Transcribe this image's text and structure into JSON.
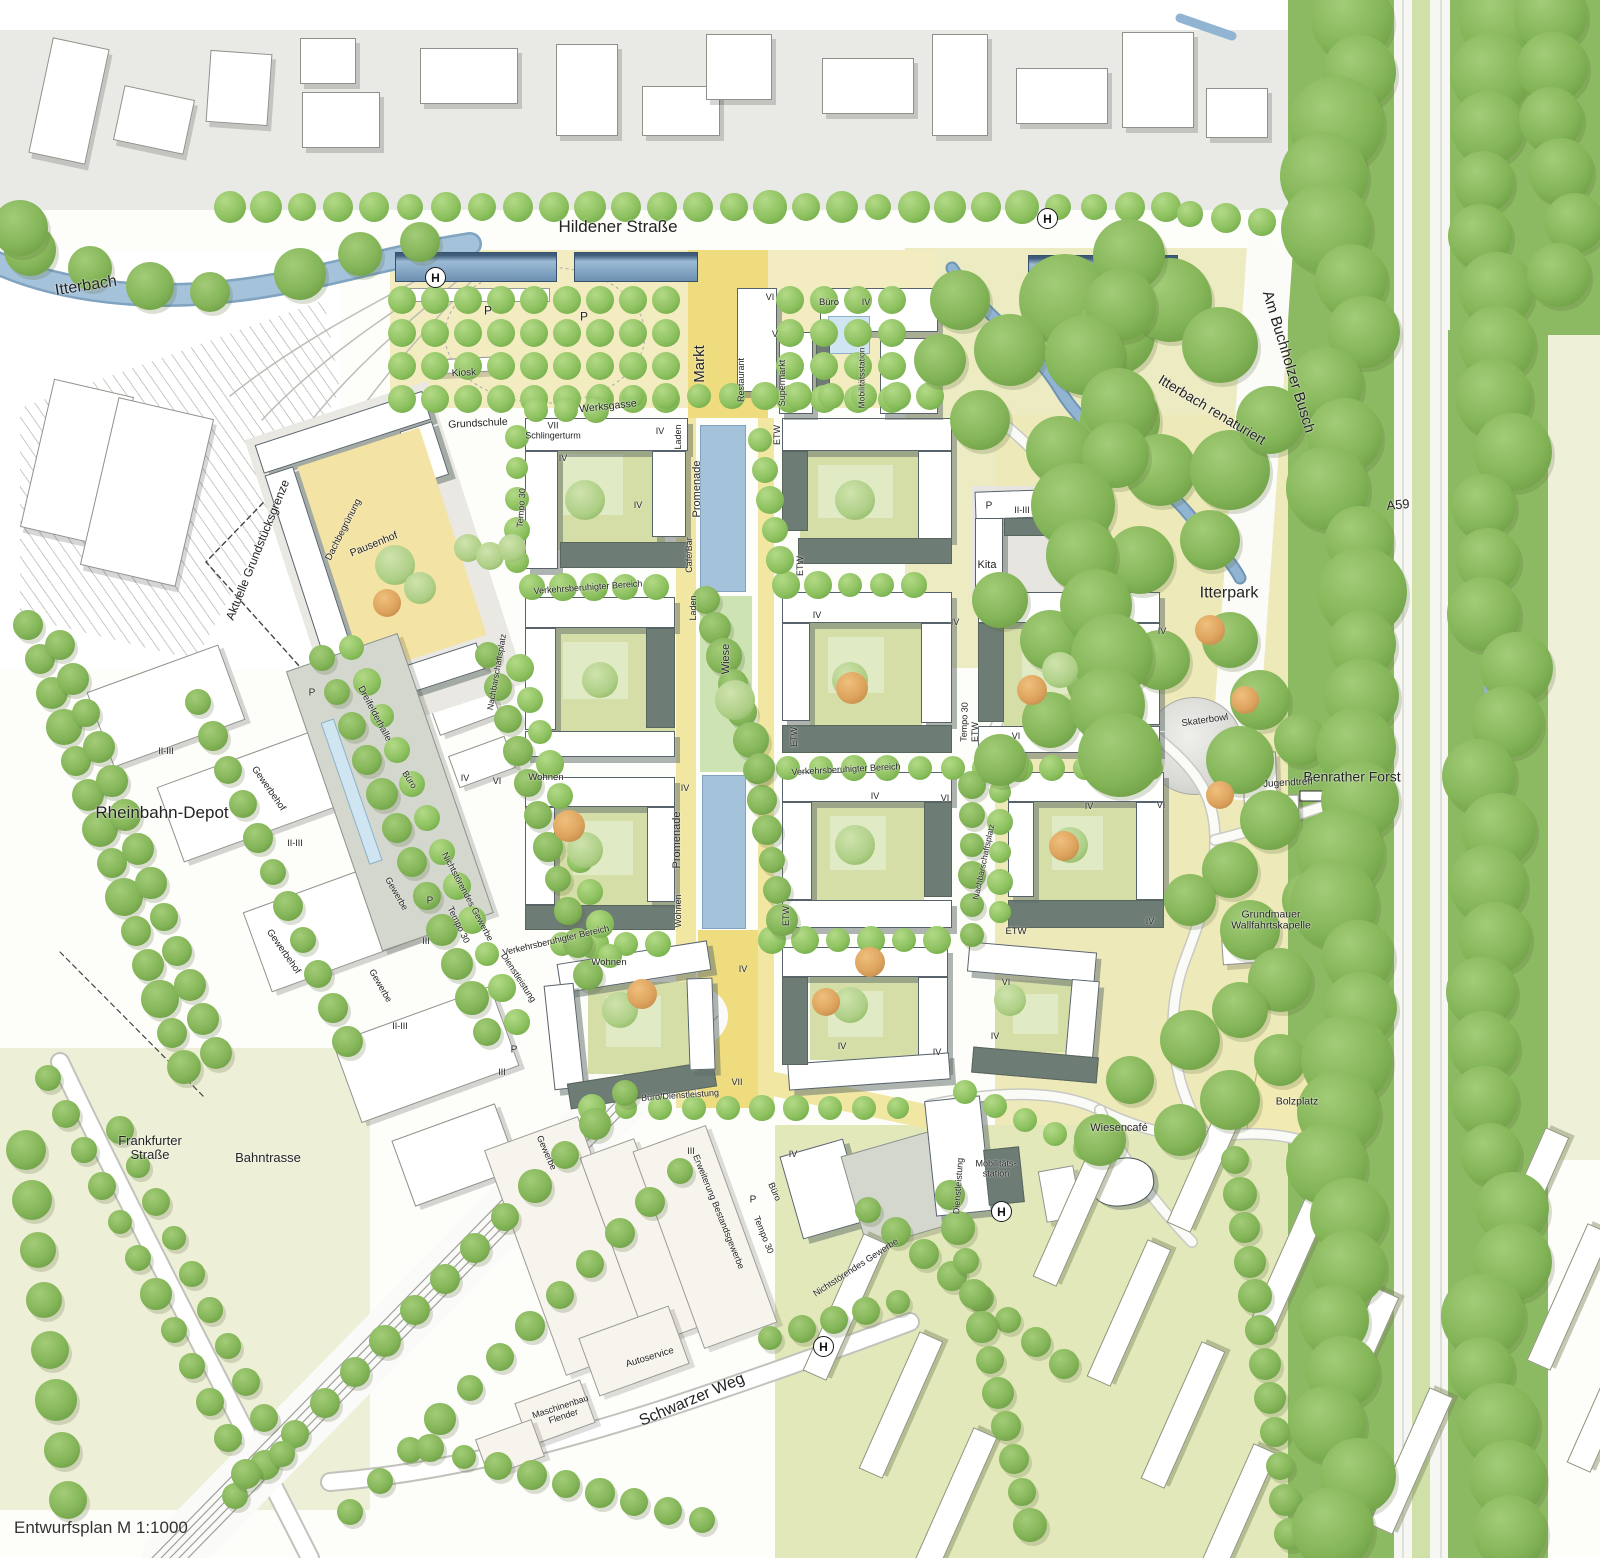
{
  "map_title": "Entwurfsplan Masterplan",
  "footer": {
    "scale_note": "Entwurfsplan M 1:1000"
  },
  "transit_stop_symbol": "H",
  "colors": {
    "water": "#a4c2da",
    "water_edge": "#7fa3c0",
    "stream": "#90b4d2",
    "forest_green": "#8cba62",
    "street_tree": "#8cc05e",
    "meadow_yellow": "#eee9b9",
    "meadow_ne": "#ecebc2",
    "plaza_light": "#f2ecc0",
    "axis_yellow": "#eedc7e",
    "promenade_yellow": "#f1e7a3",
    "courtyard_olive": "#d5dea6",
    "lawn_light": "#e0ebc6",
    "roof_dark": "#6d7c74",
    "canopy_blue": "#7b9cc0",
    "lawn_se": "#e2e8ba",
    "lawn_sw": "#edefd6",
    "median_a59": "#cfe0a8",
    "existing_parcel": "#e9e9e5",
    "paving_grey": "#e9e8e2"
  },
  "stops": [
    {
      "x": 435,
      "y": 277
    },
    {
      "x": 1047,
      "y": 218
    },
    {
      "x": 1001,
      "y": 1211
    },
    {
      "x": 823,
      "y": 1346
    }
  ],
  "labels": [
    {
      "t": "Hildener Straße",
      "x": 618,
      "y": 227,
      "r": 0,
      "s": 17
    },
    {
      "t": "Itterbach",
      "x": 86,
      "y": 286,
      "r": -9,
      "s": 16
    },
    {
      "t": "Rheinbahn-Depot",
      "x": 162,
      "y": 813,
      "r": 0,
      "s": 17
    },
    {
      "t": "Aktuelle Grundstücksgrenze",
      "x": 258,
      "y": 550,
      "r": -68,
      "s": 12
    },
    {
      "t": "Am Buchholzer Busch",
      "x": 1288,
      "y": 362,
      "r": 73,
      "s": 15
    },
    {
      "t": "Itterbach renaturiert",
      "x": 1212,
      "y": 410,
      "r": 31,
      "s": 14
    },
    {
      "t": "A59",
      "x": 1398,
      "y": 505,
      "r": -5,
      "s": 13
    },
    {
      "t": "Benrather Forst",
      "x": 1352,
      "y": 777,
      "r": 0,
      "s": 14
    },
    {
      "t": "Itterpark",
      "x": 1229,
      "y": 593,
      "r": 0,
      "s": 16
    },
    {
      "t": "Frankfurter\nStraße",
      "x": 150,
      "y": 1148,
      "r": 0,
      "s": 13
    },
    {
      "t": "Bahntrasse",
      "x": 268,
      "y": 1158,
      "r": 0,
      "s": 13
    },
    {
      "t": "Schwarzer Weg",
      "x": 692,
      "y": 1400,
      "r": -23,
      "s": 16
    },
    {
      "t": "Markt",
      "x": 700,
      "y": 364,
      "r": -90,
      "s": 15
    },
    {
      "t": "Werksgasse",
      "x": 608,
      "y": 407,
      "r": -6,
      "s": 10.5
    },
    {
      "t": "Kiosk",
      "x": 464,
      "y": 374,
      "r": -3,
      "s": 10
    },
    {
      "t": "Grundschule",
      "x": 478,
      "y": 424,
      "r": -3,
      "s": 10.5
    },
    {
      "t": "Pausenhof",
      "x": 374,
      "y": 545,
      "r": -22,
      "s": 10.5
    },
    {
      "t": "Dachbegrünung",
      "x": 344,
      "y": 530,
      "r": -63,
      "s": 9.5
    },
    {
      "t": "Dreifelderhalle",
      "x": 374,
      "y": 714,
      "r": 62,
      "s": 9.5
    },
    {
      "t": "VII\nSchlingerturm",
      "x": 553,
      "y": 431,
      "r": 0,
      "s": 9
    },
    {
      "t": "Tempo 30",
      "x": 522,
      "y": 508,
      "r": -86,
      "s": 9
    },
    {
      "t": "Tempo 30",
      "x": 965,
      "y": 722,
      "r": -88,
      "s": 9
    },
    {
      "t": "Tempo 30",
      "x": 458,
      "y": 925,
      "r": 64,
      "s": 9
    },
    {
      "t": "Tempo 30",
      "x": 763,
      "y": 1235,
      "r": 68,
      "s": 9
    },
    {
      "t": "Promenade",
      "x": 698,
      "y": 489,
      "r": -90,
      "s": 11
    },
    {
      "t": "Promenade",
      "x": 678,
      "y": 840,
      "r": -90,
      "s": 11
    },
    {
      "t": "Wiese",
      "x": 727,
      "y": 659,
      "r": -90,
      "s": 11
    },
    {
      "t": "Verkehrsberuhigter Bereich",
      "x": 588,
      "y": 588,
      "r": -4,
      "s": 9
    },
    {
      "t": "Verkehrsberuhigter Bereich",
      "x": 846,
      "y": 770,
      "r": -3,
      "s": 9
    },
    {
      "t": "Verkehrsberuhigter Bereich",
      "x": 556,
      "y": 941,
      "r": -13,
      "s": 9
    },
    {
      "t": "Nachbarschaftsplatz",
      "x": 497,
      "y": 672,
      "r": -80,
      "s": 8.5
    },
    {
      "t": "Nachbarschaftsplatz",
      "x": 984,
      "y": 862,
      "r": -78,
      "s": 8.5
    },
    {
      "t": "Kita",
      "x": 987,
      "y": 566,
      "r": 0,
      "s": 11
    },
    {
      "t": "Skaterbowl",
      "x": 1205,
      "y": 721,
      "r": -8,
      "s": 9.5
    },
    {
      "t": "Jugendtreff",
      "x": 1288,
      "y": 784,
      "r": -3,
      "s": 10
    },
    {
      "t": "Grundmauer\nWallfahrtskapelle",
      "x": 1271,
      "y": 921,
      "r": 0,
      "s": 10.5
    },
    {
      "t": "Bolzplatz",
      "x": 1297,
      "y": 1102,
      "r": 0,
      "s": 10.5
    },
    {
      "t": "Wiesencafé",
      "x": 1119,
      "y": 1129,
      "r": 0,
      "s": 11
    },
    {
      "t": "Mobilitäts-\nstation",
      "x": 996,
      "y": 1169,
      "r": 0,
      "s": 9
    },
    {
      "t": "Dienstleistung",
      "x": 959,
      "y": 1186,
      "r": -86,
      "s": 9
    },
    {
      "t": "Dienstleistung",
      "x": 518,
      "y": 978,
      "r": 57,
      "s": 9
    },
    {
      "t": "Büro/Dienstleistung",
      "x": 680,
      "y": 1096,
      "r": -4,
      "s": 9
    },
    {
      "t": "Wohnen",
      "x": 546,
      "y": 778,
      "r": 0,
      "s": 9.5
    },
    {
      "t": "Wohnen",
      "x": 609,
      "y": 963,
      "r": 0,
      "s": 9.5
    },
    {
      "t": "Wohnen",
      "x": 679,
      "y": 911,
      "r": -90,
      "s": 9
    },
    {
      "t": "ETW",
      "x": 778,
      "y": 435,
      "r": -90,
      "s": 9
    },
    {
      "t": "ETW",
      "x": 801,
      "y": 566,
      "r": -90,
      "s": 9
    },
    {
      "t": "ETW",
      "x": 795,
      "y": 737,
      "r": -90,
      "s": 9
    },
    {
      "t": "ETW",
      "x": 787,
      "y": 916,
      "r": -90,
      "s": 9
    },
    {
      "t": "ETW",
      "x": 976,
      "y": 732,
      "r": -90,
      "s": 9
    },
    {
      "t": "ETW",
      "x": 1016,
      "y": 932,
      "r": 0,
      "s": 9.5
    },
    {
      "t": "Laden",
      "x": 679,
      "y": 437,
      "r": -90,
      "s": 9
    },
    {
      "t": "Laden",
      "x": 694,
      "y": 608,
      "r": -90,
      "s": 9
    },
    {
      "t": "Café/Bar",
      "x": 690,
      "y": 555,
      "r": -90,
      "s": 9
    },
    {
      "t": "Restaurant",
      "x": 742,
      "y": 380,
      "r": -90,
      "s": 9
    },
    {
      "t": "Supermarkt",
      "x": 783,
      "y": 383,
      "r": -90,
      "s": 9
    },
    {
      "t": "Mobilitätsstation",
      "x": 862,
      "y": 378,
      "r": -90,
      "s": 8.5
    },
    {
      "t": "Büro",
      "x": 829,
      "y": 303,
      "r": 0,
      "s": 9.5
    },
    {
      "t": "Büro",
      "x": 409,
      "y": 780,
      "r": 57,
      "s": 9
    },
    {
      "t": "Büro",
      "x": 774,
      "y": 1192,
      "r": 66,
      "s": 9
    },
    {
      "t": "Gewerbe",
      "x": 396,
      "y": 894,
      "r": 60,
      "s": 9
    },
    {
      "t": "Gewerbe",
      "x": 380,
      "y": 986,
      "r": 60,
      "s": 9
    },
    {
      "t": "Gewerbe",
      "x": 546,
      "y": 1153,
      "r": 66,
      "s": 9
    },
    {
      "t": "Gewerbehof",
      "x": 268,
      "y": 789,
      "r": 55,
      "s": 9.5
    },
    {
      "t": "Gewerbehof",
      "x": 283,
      "y": 952,
      "r": 55,
      "s": 9.5
    },
    {
      "t": "Erweiterung Bestandsgewerbe",
      "x": 718,
      "y": 1212,
      "r": 68,
      "s": 9
    },
    {
      "t": "Autoservice",
      "x": 650,
      "y": 1358,
      "r": -17,
      "s": 9.5
    },
    {
      "t": "Maschinenbau\nFlender",
      "x": 562,
      "y": 1412,
      "r": -18,
      "s": 9
    },
    {
      "t": "Nichtstörendes Gewerbe",
      "x": 467,
      "y": 897,
      "r": 62,
      "s": 9
    },
    {
      "t": "Nichtstörendes Gewerbe",
      "x": 856,
      "y": 1268,
      "r": -33,
      "s": 9
    },
    {
      "t": "IV",
      "x": 660,
      "y": 432,
      "r": 0,
      "s": 9
    },
    {
      "t": "IV",
      "x": 563,
      "y": 459,
      "r": 0,
      "s": 9
    },
    {
      "t": "IV",
      "x": 638,
      "y": 506,
      "r": 0,
      "s": 9
    },
    {
      "t": "IV",
      "x": 817,
      "y": 616,
      "r": 0,
      "s": 9
    },
    {
      "t": "IV",
      "x": 955,
      "y": 623,
      "r": 0,
      "s": 9
    },
    {
      "t": "IV",
      "x": 1162,
      "y": 632,
      "r": 0,
      "s": 9
    },
    {
      "t": "IV",
      "x": 875,
      "y": 797,
      "r": 0,
      "s": 9
    },
    {
      "t": "IV",
      "x": 685,
      "y": 789,
      "r": 0,
      "s": 9
    },
    {
      "t": "IV",
      "x": 1089,
      "y": 807,
      "r": 0,
      "s": 9
    },
    {
      "t": "IV",
      "x": 1150,
      "y": 922,
      "r": 0,
      "s": 9
    },
    {
      "t": "IV",
      "x": 995,
      "y": 1037,
      "r": 0,
      "s": 9
    },
    {
      "t": "IV",
      "x": 937,
      "y": 1053,
      "r": 0,
      "s": 9
    },
    {
      "t": "IV",
      "x": 743,
      "y": 970,
      "r": 0,
      "s": 9
    },
    {
      "t": "IV",
      "x": 842,
      "y": 1047,
      "r": 0,
      "s": 9
    },
    {
      "t": "IV",
      "x": 793,
      "y": 1155,
      "r": 0,
      "s": 9
    },
    {
      "t": "IV",
      "x": 465,
      "y": 779,
      "r": 0,
      "s": 9
    },
    {
      "t": "IV",
      "x": 866,
      "y": 303,
      "r": 0,
      "s": 9
    },
    {
      "t": "VI",
      "x": 770,
      "y": 298,
      "r": 0,
      "s": 9
    },
    {
      "t": "VI",
      "x": 945,
      "y": 799,
      "r": 0,
      "s": 9
    },
    {
      "t": "VI",
      "x": 1016,
      "y": 737,
      "r": 0,
      "s": 9
    },
    {
      "t": "VI",
      "x": 1006,
      "y": 983,
      "r": 0,
      "s": 9
    },
    {
      "t": "VI",
      "x": 497,
      "y": 782,
      "r": 0,
      "s": 9
    },
    {
      "t": "VI",
      "x": 1161,
      "y": 806,
      "r": 0,
      "s": 9
    },
    {
      "t": "V",
      "x": 775,
      "y": 335,
      "r": 0,
      "s": 9
    },
    {
      "t": "VII",
      "x": 737,
      "y": 1083,
      "r": 0,
      "s": 9
    },
    {
      "t": "III",
      "x": 426,
      "y": 942,
      "r": 0,
      "s": 9
    },
    {
      "t": "III",
      "x": 502,
      "y": 1073,
      "r": 0,
      "s": 9
    },
    {
      "t": "III",
      "x": 691,
      "y": 1152,
      "r": 0,
      "s": 9
    },
    {
      "t": "II-III",
      "x": 166,
      "y": 752,
      "r": 0,
      "s": 9
    },
    {
      "t": "II-III",
      "x": 295,
      "y": 844,
      "r": 0,
      "s": 9
    },
    {
      "t": "II-III",
      "x": 400,
      "y": 1027,
      "r": 0,
      "s": 9
    },
    {
      "t": "II-III",
      "x": 1022,
      "y": 511,
      "r": 0,
      "s": 9
    },
    {
      "t": "P",
      "x": 488,
      "y": 311,
      "r": 0,
      "s": 12
    },
    {
      "t": "P",
      "x": 584,
      "y": 317,
      "r": 0,
      "s": 12
    },
    {
      "t": "P",
      "x": 989,
      "y": 507,
      "r": 0,
      "s": 10
    },
    {
      "t": "P",
      "x": 312,
      "y": 694,
      "r": 0,
      "s": 10
    },
    {
      "t": "P",
      "x": 430,
      "y": 902,
      "r": 0,
      "s": 10
    },
    {
      "t": "P",
      "x": 514,
      "y": 1051,
      "r": 0,
      "s": 10
    },
    {
      "t": "P",
      "x": 753,
      "y": 1201,
      "r": 0,
      "s": 10
    }
  ]
}
